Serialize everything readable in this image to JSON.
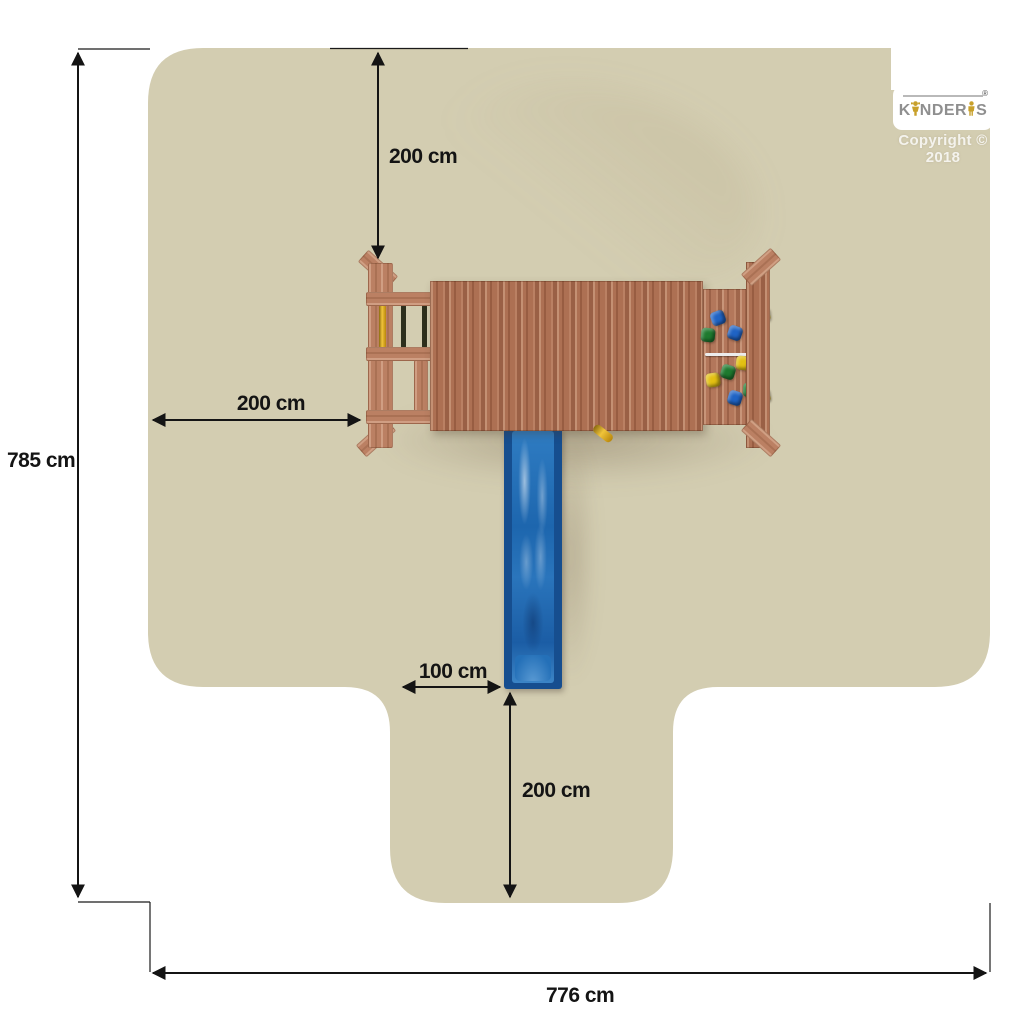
{
  "title": "Playground set top-view safety zone diagram",
  "watermark": {
    "brand_k": "K",
    "brand_nder": "NDER",
    "brand_s": "S",
    "registered": "®",
    "copyright": "Copyright © 2018"
  },
  "dimensions": {
    "top_clearance": {
      "label": "200 cm"
    },
    "left_clearance": {
      "label": "200 cm"
    },
    "slide_side_offset": {
      "label": "100 cm"
    },
    "slide_runout": {
      "label": "200 cm"
    },
    "total_depth": {
      "label": "785 cm"
    },
    "total_width": {
      "label": "776 cm"
    }
  },
  "scene": {
    "colors": {
      "safety_zone": "#d3cdb1",
      "wood": "#ad7053",
      "wood_light": "#bb8063",
      "slide_frame": "#164e8f",
      "slide_body": "#2470b8",
      "pole_yellow": "#e0ac1e",
      "pole_dark": "#2d2f1d",
      "dimension_ink": "#141414",
      "logo_gray": "#8f8f8f",
      "logo_gold": "#c8a02a",
      "hold_blue": "#1f63c4",
      "hold_green": "#1e7a2f",
      "hold_yellow": "#e3c012"
    },
    "climbing_holds": [
      {
        "x": 718,
        "y": 318,
        "color": "#1f63c4"
      },
      {
        "x": 763,
        "y": 315,
        "color": "#e3c012"
      },
      {
        "x": 708,
        "y": 335,
        "color": "#1e7a2f"
      },
      {
        "x": 735,
        "y": 333,
        "color": "#1f63c4"
      },
      {
        "x": 755,
        "y": 330,
        "color": "#1f63c4"
      },
      {
        "x": 743,
        "y": 363,
        "color": "#e3c012"
      },
      {
        "x": 728,
        "y": 372,
        "color": "#1e7a2f"
      },
      {
        "x": 713,
        "y": 380,
        "color": "#e3c012"
      },
      {
        "x": 750,
        "y": 390,
        "color": "#1e7a2f"
      },
      {
        "x": 735,
        "y": 398,
        "color": "#1f63c4"
      },
      {
        "x": 763,
        "y": 396,
        "color": "#e3c012"
      }
    ]
  }
}
